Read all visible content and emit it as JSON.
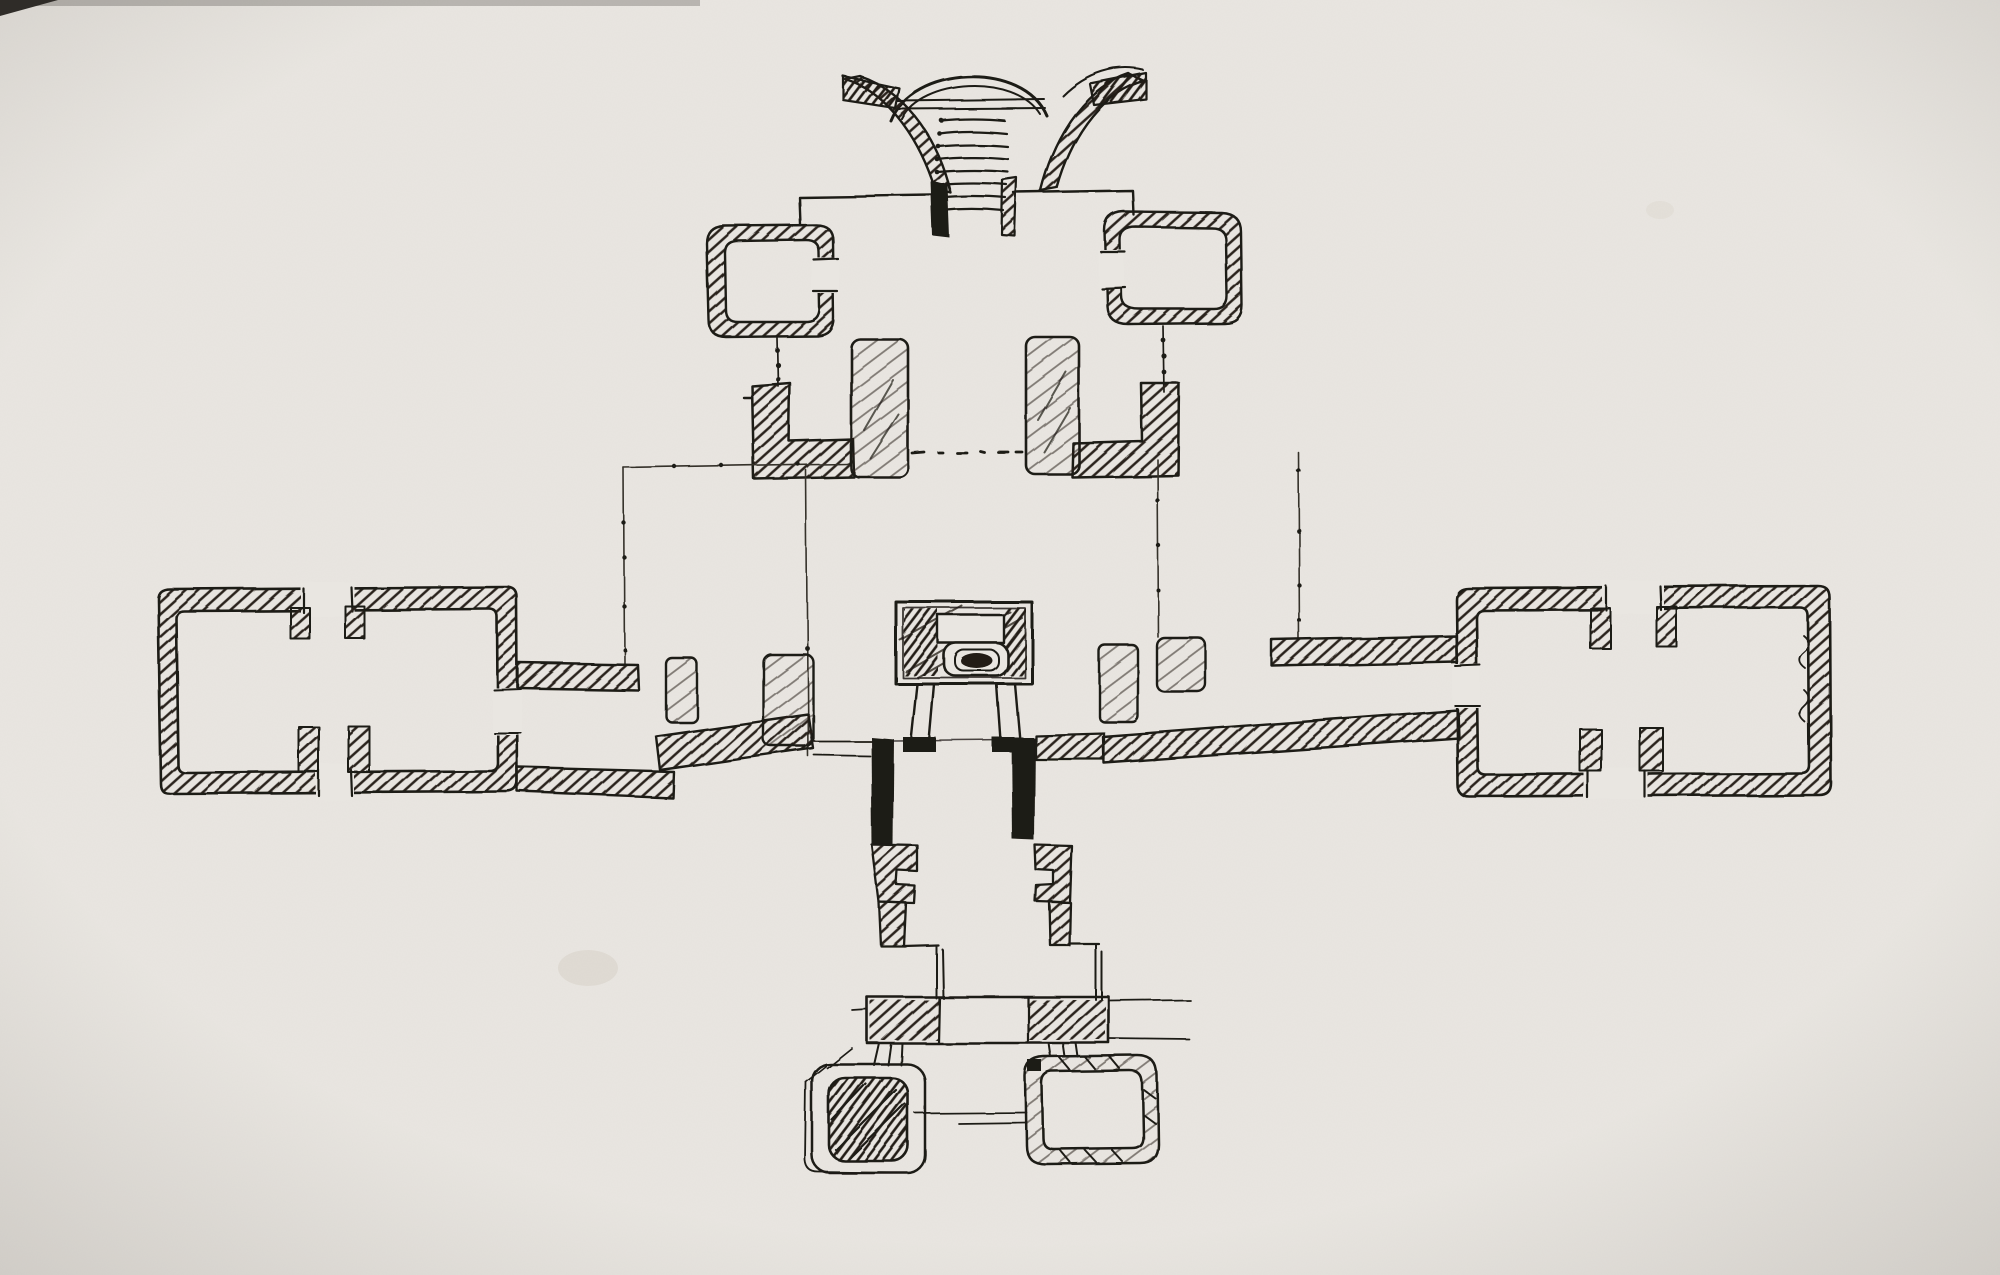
{
  "page": {
    "title": "Hand-drawn architectural floor-plan sketch",
    "medium": "black ink on off-white paper"
  },
  "colors": {
    "paper": "#e9e6e1",
    "ink": "#1f1a15",
    "hatch": "#2a241d",
    "construction_line": "#35302a"
  },
  "artwork": {
    "elements": [
      {
        "id": "entry-stair",
        "label": "flared trumpet-shaped entry stair with treads and domed head, top of plan"
      },
      {
        "id": "north-outline",
        "label": "thin outline of the north block flanking the stair"
      },
      {
        "id": "room-northwest",
        "label": "small rounded-corner room north-west with door on its east wall"
      },
      {
        "id": "room-northeast",
        "label": "small rounded-corner room north-east with door on its west wall"
      },
      {
        "id": "pier-west",
        "label": "L-shaped hatched wall pier below the north-west room"
      },
      {
        "id": "pier-east",
        "label": "L-shaped hatched wall pier below the north-east room"
      },
      {
        "id": "pillar-west",
        "label": "free-standing pillar west of the central axis"
      },
      {
        "id": "pillar-east",
        "label": "free-standing pillar east of the central axis"
      },
      {
        "id": "axis-dots",
        "label": "dotted axis line between the pillars"
      },
      {
        "id": "construction-lines",
        "label": "thin ticked construction and setting-out lines"
      },
      {
        "id": "hall-west",
        "label": "large west hall with doorways in the north and south walls"
      },
      {
        "id": "corridor-west",
        "label": "west corridor linking the west hall to the crossing"
      },
      {
        "id": "hall-east",
        "label": "large east hall with doorways in the north and south walls"
      },
      {
        "id": "corridor-east",
        "label": "east corridor linking the east hall to the crossing"
      },
      {
        "id": "crossing",
        "label": "central crossing with flanking piers and dark side walls"
      },
      {
        "id": "shrine",
        "label": "central shrine or altar canopy on four legs"
      },
      {
        "id": "south-corridor",
        "label": "narrow south corridor with notched jog walls"
      },
      {
        "id": "porch-bar",
        "label": "south threshold porch bar with hatched ends"
      },
      {
        "id": "room-southwest",
        "label": "small rounded room south-west with solid hatched core"
      },
      {
        "id": "room-southeast",
        "label": "small rounded room south-east with hollow hatched wall"
      },
      {
        "id": "connector-lines",
        "label": "thin connector lines between the two south rooms"
      }
    ]
  }
}
